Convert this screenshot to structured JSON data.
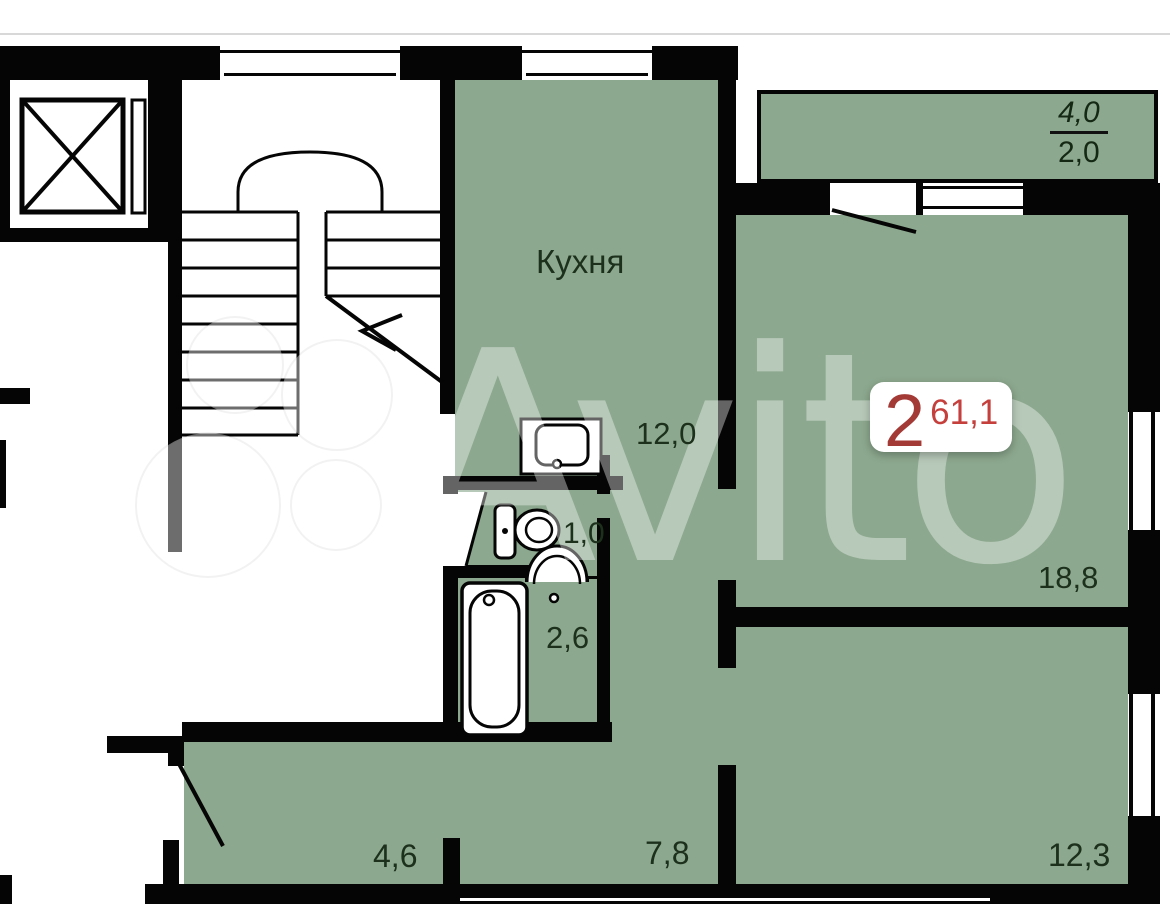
{
  "page": {
    "type": "apartment-floor-plan"
  },
  "badge": {
    "rooms_count": "2",
    "total_area": "61,1"
  },
  "rooms": {
    "kitchen": {
      "name": "Кухня",
      "area": "12,0"
    },
    "wc": {
      "area": "1,0"
    },
    "bathroom": {
      "area": "2,6"
    },
    "living_room": {
      "area": "18,8"
    },
    "bedroom": {
      "area": "12,3"
    },
    "hallway": {
      "area": "4,6"
    },
    "corridor": {
      "area": "7,8"
    },
    "balcony": {
      "area_total": "4,0",
      "area_coefficient": "2,0"
    }
  },
  "watermark": {
    "text": "Avito"
  },
  "fixtures": [
    "elevator-shaft",
    "staircase",
    "kitchen-sink",
    "toilet",
    "washbasin",
    "bathtub",
    "entrance-door",
    "balcony-door",
    "wc-door"
  ],
  "colors": {
    "room_fill": "#8ca88e",
    "wall": "#050505",
    "label_text": "#1c301c",
    "badge_rooms": "#a33a36",
    "badge_area": "#c5403d"
  }
}
